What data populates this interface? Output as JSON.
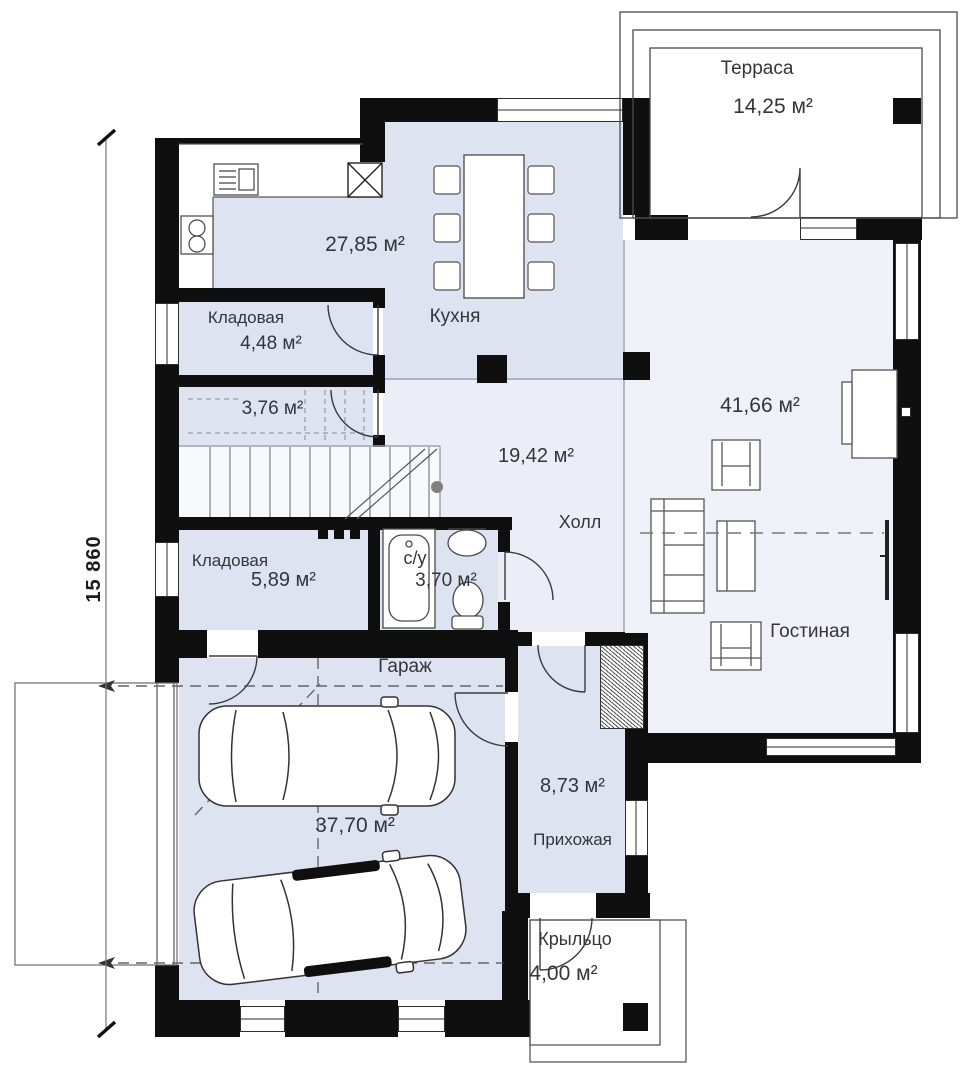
{
  "dimension": {
    "left": "15 860"
  },
  "rooms": {
    "terrace": {
      "name": "Терраса",
      "area": "14,25 м²"
    },
    "kitchen": {
      "name": "Кухня",
      "area": "27,85 м²"
    },
    "pantry_top": {
      "name": "Кладовая",
      "area": "4,48 м²"
    },
    "understair": {
      "area": "3,76 м²"
    },
    "hall": {
      "name": "Холл",
      "area": "19,42 м²"
    },
    "living": {
      "name": "Гостиная",
      "area": "41,66 м²"
    },
    "pantry_bottom": {
      "name": "Кладовая",
      "area": "5,89 м²"
    },
    "wc": {
      "name": "с/у",
      "area": "3,70 м²"
    },
    "garage": {
      "name": "Гараж",
      "area": "37,70 м²"
    },
    "entry": {
      "name": "Прихожая",
      "area": "8,73 м²"
    },
    "porch": {
      "name": "Крыльцо",
      "area": "4,00 м²"
    }
  },
  "colors": {
    "wall": "#0f0f0f",
    "service_floor": "#dde3f0",
    "main_floor": "#ebeef6",
    "living_floor": "#eef1f8",
    "text": "#35353a"
  }
}
